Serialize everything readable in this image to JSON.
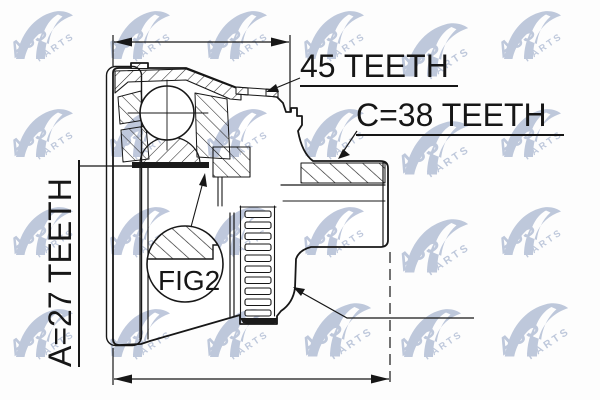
{
  "drawing": {
    "type": "technical-part-diagram",
    "subject": "cv-joint-outer-half-section",
    "labels": {
      "teeth_45": "45 TEETH",
      "teeth_c38": "C=38 TEETH",
      "teeth_a27": "A=27 TEETH",
      "fig": "FIG2"
    },
    "dimensions": [
      {
        "id": "top-width-dimension",
        "value_label": ""
      },
      {
        "id": "bottom-overall-length-dimension",
        "value_label": ""
      }
    ],
    "colors": {
      "line": "#171717",
      "background": "#fdfdfd",
      "watermark": "#b4bfd6",
      "bore_band": "#1b1b1b"
    }
  },
  "watermark": {
    "brand": "AJS",
    "sub": "PARTS"
  }
}
